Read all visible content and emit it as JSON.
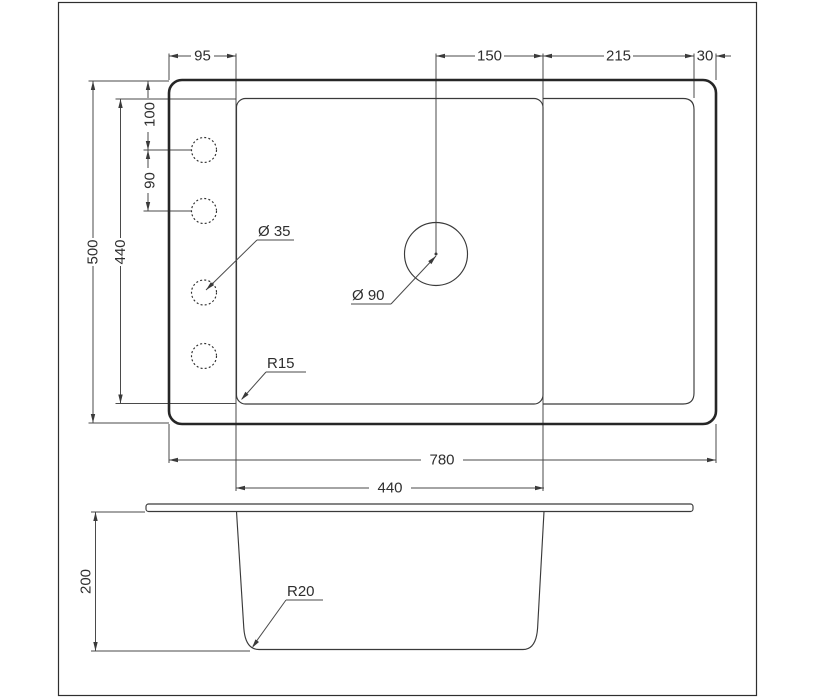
{
  "drawing_title": "sink-technical-drawing",
  "colors": {
    "highlight": "#4a84b6",
    "line": "#4a4a4a",
    "outline": "#262626",
    "text": "#2e2e2e",
    "background": "#ffffff"
  },
  "top_view": {
    "top_dims": {
      "deck": "95",
      "drain_to_divider": "150",
      "drainboard": "215",
      "edge": "30"
    },
    "left_dims": {
      "overall_length": "500",
      "inner_length": "440",
      "hole_offset": "100",
      "hole_spacing": "90"
    },
    "bottom_dims": {
      "overall_width": "780",
      "bowl_width": "440"
    },
    "labels": {
      "faucet_hole": "Ø 35",
      "drain": "Ø 90",
      "corner_radius": "R15"
    }
  },
  "section_view": {
    "depth": "200",
    "bottom_radius": "R20"
  }
}
